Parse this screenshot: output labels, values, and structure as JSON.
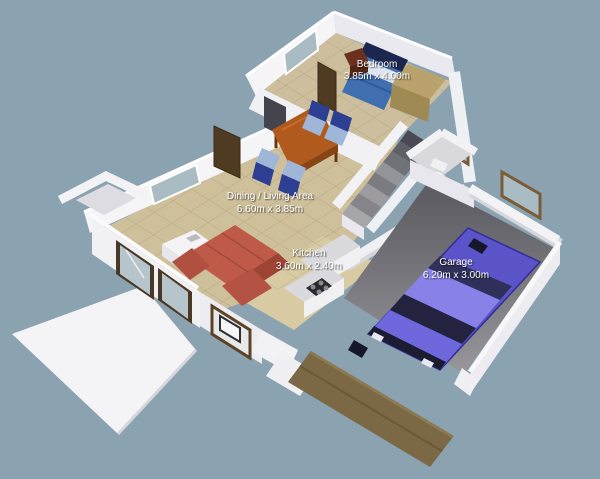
{
  "rooms": {
    "bedroom": {
      "name": "Bedroom",
      "dims": "3.85m x 4.00m"
    },
    "dining": {
      "name": "Dining / Living Area",
      "dims": "6.60m x 3.85m"
    },
    "kitchen": {
      "name": "Kitchen",
      "dims": "3.60m x 2.40m"
    },
    "garage": {
      "name": "Garage",
      "dims": "6.20m x 3.00m"
    }
  },
  "objects": [
    "double-bed",
    "nightstand",
    "wardrobe",
    "dining-table",
    "dining-chair",
    "corner-sofa",
    "tv-stand",
    "sliding-patio-door",
    "bay-window",
    "kitchen-counter",
    "kitchen-sink",
    "cooktop",
    "staircase",
    "toilet",
    "car",
    "garage-door",
    "patio-slab",
    "window"
  ],
  "colors": {
    "background": "#8BA3B1",
    "wall": "#F3F3F6",
    "wall_shade": "#E6E6EC",
    "carpet": "#CFC09C",
    "tile": "#D8CBA3",
    "garage_floor": "#707075",
    "stairs": "#9C9CA0",
    "car": "#5B54C9",
    "sofa": "#C05A48",
    "table": "#B05A1E",
    "chair_back": "#2C3F93",
    "chair_seat": "#9FB6D8",
    "bed": "#3F6FAE",
    "headboard": "#1C2750",
    "wood_frame": "#5D4226",
    "wardrobe": "#B9A26B",
    "glass": "#A9BCC4",
    "label": "#FFFFFF"
  }
}
